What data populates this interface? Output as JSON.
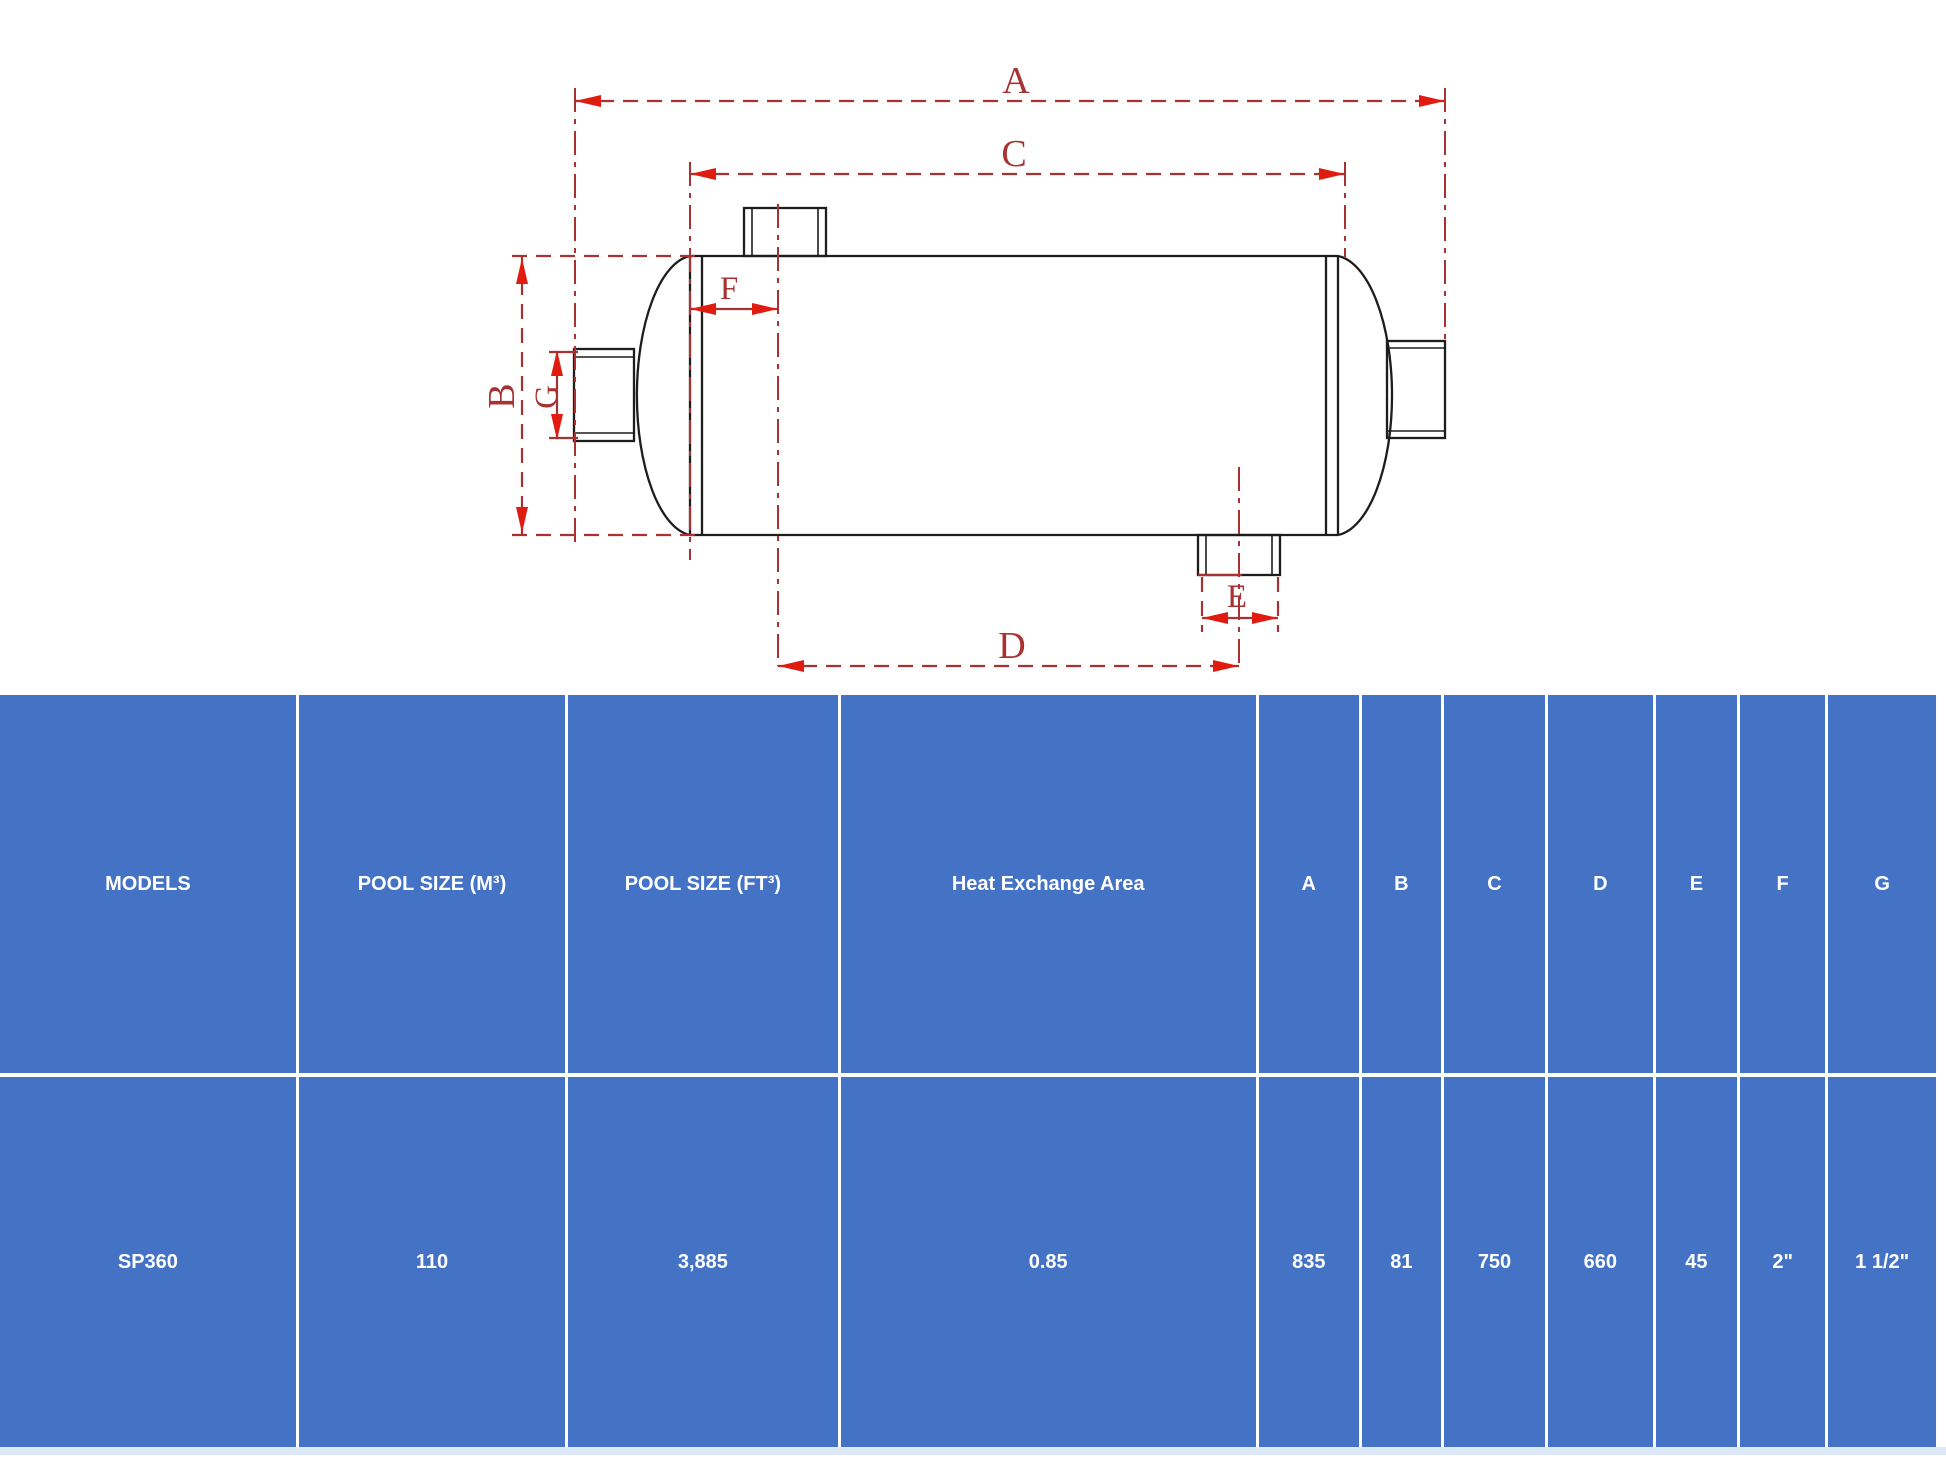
{
  "theme": {
    "table_blue": "#4472c4",
    "table_text": "#ffffff",
    "separator": "#ffffff",
    "footer_strip": "#dde9f7",
    "dim_red": "#a83232",
    "arrow_red": "#e01b0f",
    "outline_black": "#1d1d1b"
  },
  "diagram": {
    "description": "Heat exchanger dimensional drawing",
    "labels": {
      "a": "A",
      "b": "B",
      "c": "C",
      "d": "D",
      "e": "E",
      "f": "F",
      "g": "G"
    }
  },
  "table": {
    "headers": [
      "MODELS",
      "POOL SIZE (M³)",
      "POOL SIZE (FT³)",
      "Heat Exchange Area",
      "A",
      "B",
      "C",
      "D",
      "E",
      "F",
      "G"
    ],
    "rows": [
      [
        "SP360",
        "110",
        "3,885",
        "0.85",
        "835",
        "81",
        "750",
        "660",
        "45",
        "2\"",
        "1 1/2\""
      ]
    ]
  }
}
